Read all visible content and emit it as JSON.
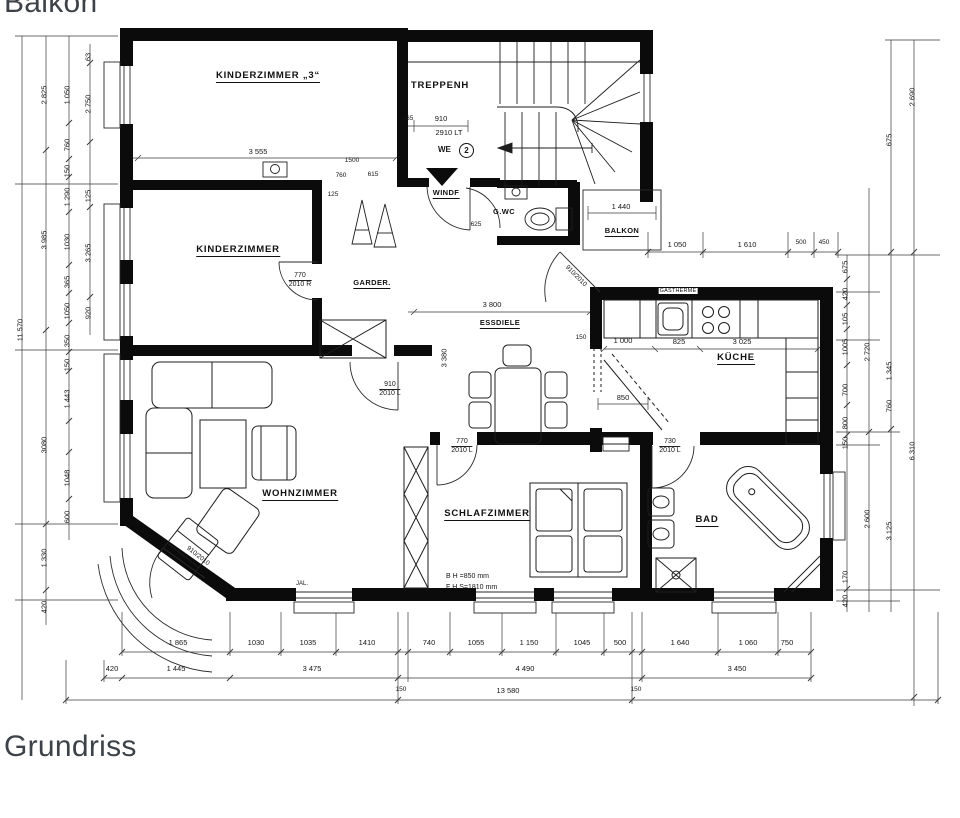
{
  "captions": {
    "top": "Balkon",
    "bottom": "Grundriss"
  },
  "rooms": {
    "kinderzimmer3": "KINDERZIMMER „3“",
    "treppenhaus": "TREPPENH",
    "windfang": "WINDF",
    "gwc": "G.WC",
    "balkon": "BALKON",
    "kinderzimmer": "KINDERZIMMER",
    "garderobe": "GARDER.",
    "essdiele": "ESSDIELE",
    "kueche": "KÜCHE",
    "wohnzimmer": "WOHNZIMMER",
    "schlafzimmer": "SCHLAFZIMMER",
    "bad": "BAD"
  },
  "doors": {
    "kinderzimmer": {
      "line1": "770",
      "line2": "2010 R"
    },
    "wohnzimmer": {
      "line1": "910",
      "line2": "2010 L"
    },
    "schlafzimmer": {
      "line1": "770",
      "line2": "2010 L"
    },
    "bad": {
      "line1": "730",
      "line2": "2010 L"
    },
    "essdiele_balkon": "910/2010",
    "wohnzimmer_balkon": "910/2010",
    "entrance": {
      "dim_small": "365",
      "dim_width": "910",
      "label": "2910 LT",
      "we": "WE",
      "we_no": "2",
      "windfang_width": "625"
    }
  },
  "annotations": {
    "bh": "B H =850 mm",
    "fhs": "F H S=1810 mm",
    "gastherme": "GASTHERME",
    "jal": "JAL."
  },
  "dims": {
    "top": [
      "1 050",
      "1 610",
      "500",
      "450"
    ],
    "balkon": "1 440",
    "kinderzimmer3": "3 555",
    "corridor": [
      "1500",
      "760",
      "615",
      "125"
    ],
    "essdiele_w": "3 800",
    "essdiele_h": "3 380",
    "essdiele_150": "150",
    "kueche": [
      "1 000",
      "825",
      "3 025"
    ],
    "kueche_open": "850",
    "left1": [
      "11 570"
    ],
    "left2": [
      "2 825",
      "3 985",
      "3080",
      "1 330",
      "420"
    ],
    "left3": [
      "1 050",
      "760",
      "150",
      "1 290",
      "1030",
      "365",
      "1050",
      "350",
      "150",
      "1 443",
      "1048",
      "600"
    ],
    "left4": [
      "63",
      "2 750",
      "125",
      "3 265",
      "920"
    ],
    "right1": [
      "675",
      "420",
      "105",
      "1005",
      "700",
      "800",
      "150",
      "170",
      "420"
    ],
    "right2": [
      "2 720",
      "2 600"
    ],
    "right3": [
      "675",
      "1 345",
      "760",
      "3 125"
    ],
    "right4": [
      "2 690",
      "6 310"
    ],
    "bottom1": [
      "1 865",
      "1030",
      "1035",
      "1410",
      "740",
      "1055",
      "1 150",
      "1045",
      "500",
      "1 640",
      "1 060",
      "750"
    ],
    "bottom2": [
      "420",
      "1 445",
      "3 475",
      "4 490",
      "3 450"
    ],
    "bottom3": [
      "150",
      "13 580",
      "150"
    ]
  }
}
